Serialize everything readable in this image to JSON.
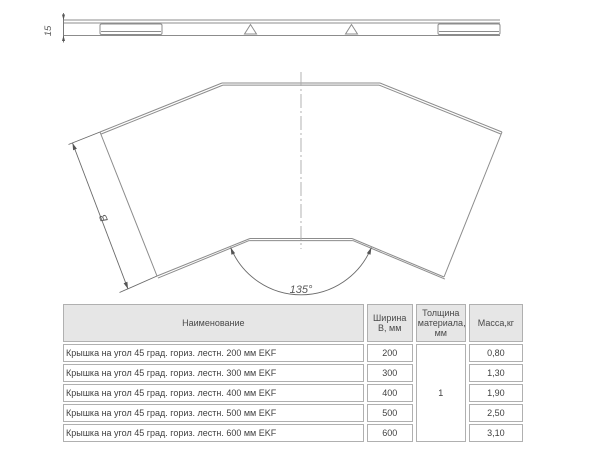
{
  "drawing": {
    "side_view": {
      "thickness_dim": "15"
    },
    "top_view": {
      "width_dim": "B",
      "angle_dim": "135°"
    },
    "line_color": "#8c8c8c",
    "dim_color": "#5a5a5a"
  },
  "table": {
    "headers": {
      "name": "Наименование",
      "width": "Ширина В, мм",
      "thickness": "Толщина материала, мм",
      "mass": "Масса,кг"
    },
    "thickness_value": "1",
    "rows": [
      {
        "name": "Крышка на угол 45 град. гориз. лестн. 200 мм EKF",
        "width": "200",
        "mass": "0,80"
      },
      {
        "name": "Крышка на угол 45 град. гориз. лестн. 300 мм EKF",
        "width": "300",
        "mass": "1,30"
      },
      {
        "name": "Крышка на угол 45 град. гориз. лестн. 400 мм EKF",
        "width": "400",
        "mass": "1,90"
      },
      {
        "name": "Крышка на угол 45 град. гориз. лестн. 500 мм EKF",
        "width": "500",
        "mass": "2,50"
      },
      {
        "name": "Крышка на угол 45 град. гориз. лестн. 600 мм EKF",
        "width": "600",
        "mass": "3,10"
      }
    ],
    "colors": {
      "header_bg": "#e6e6e6",
      "border": "#b0b0b0",
      "text": "#3f3f3f"
    }
  }
}
